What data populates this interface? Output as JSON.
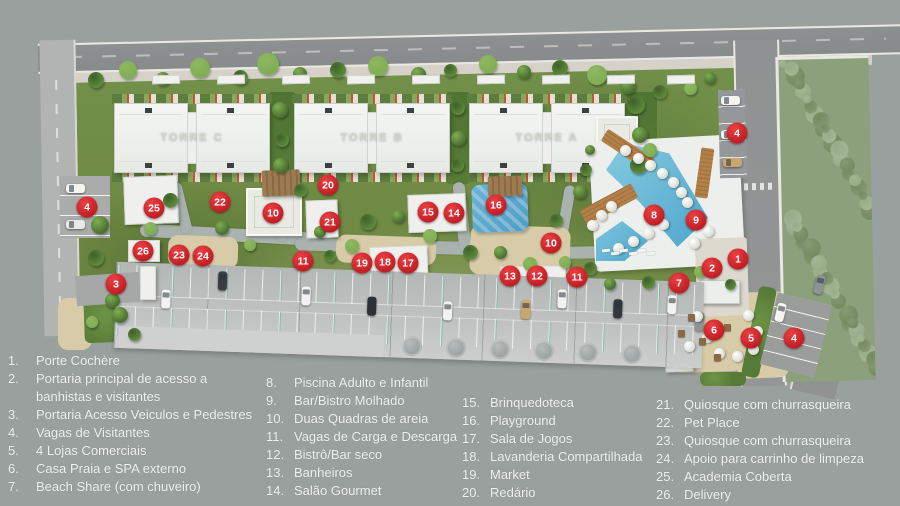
{
  "map": {
    "towers": [
      {
        "label": "TORRE C"
      },
      {
        "label": "TORRE B"
      },
      {
        "label": "TORRE A"
      }
    ],
    "markers": [
      {
        "num": "1",
        "x": 738,
        "y": 259
      },
      {
        "num": "2",
        "x": 712,
        "y": 268
      },
      {
        "num": "3",
        "x": 116,
        "y": 284
      },
      {
        "num": "4",
        "x": 87,
        "y": 207
      },
      {
        "num": "4",
        "x": 737,
        "y": 133
      },
      {
        "num": "4",
        "x": 794,
        "y": 338
      },
      {
        "num": "5",
        "x": 751,
        "y": 338
      },
      {
        "num": "6",
        "x": 714,
        "y": 330
      },
      {
        "num": "7",
        "x": 679,
        "y": 283
      },
      {
        "num": "8",
        "x": 654,
        "y": 215
      },
      {
        "num": "9",
        "x": 696,
        "y": 220
      },
      {
        "num": "10",
        "x": 273,
        "y": 213
      },
      {
        "num": "10",
        "x": 551,
        "y": 243
      },
      {
        "num": "11",
        "x": 303,
        "y": 261
      },
      {
        "num": "11",
        "x": 577,
        "y": 277
      },
      {
        "num": "12",
        "x": 537,
        "y": 276
      },
      {
        "num": "13",
        "x": 510,
        "y": 276
      },
      {
        "num": "14",
        "x": 454,
        "y": 213
      },
      {
        "num": "15",
        "x": 428,
        "y": 212
      },
      {
        "num": "16",
        "x": 496,
        "y": 205
      },
      {
        "num": "17",
        "x": 408,
        "y": 263
      },
      {
        "num": "18",
        "x": 385,
        "y": 262
      },
      {
        "num": "19",
        "x": 362,
        "y": 263
      },
      {
        "num": "20",
        "x": 328,
        "y": 185
      },
      {
        "num": "21",
        "x": 330,
        "y": 222
      },
      {
        "num": "22",
        "x": 220,
        "y": 202
      },
      {
        "num": "23",
        "x": 179,
        "y": 255
      },
      {
        "num": "24",
        "x": 203,
        "y": 256
      },
      {
        "num": "25",
        "x": 154,
        "y": 208
      },
      {
        "num": "26",
        "x": 143,
        "y": 251
      }
    ],
    "colors": {
      "background_gray": "#9aa09d",
      "road_gray": "#8b8e8e",
      "grass_green": "#6e8844",
      "pool_blue": "#5fb0d3",
      "sand_tan": "#d8cca8",
      "wood_brown": "#b28049",
      "marker_red": "#c81f24",
      "legend_text": "#eff1ee"
    }
  },
  "legend": {
    "columns": [
      {
        "items": [
          {
            "num": "1.",
            "text": "Porte Cochère"
          },
          {
            "num": "2.",
            "text": "Portaria principal de acesso a banhistas e visitantes"
          },
          {
            "num": "3.",
            "text": "Portaria Acesso Veiculos e Pedestres"
          },
          {
            "num": "4.",
            "text": "Vagas de Visitantes"
          },
          {
            "num": "5.",
            "text": "4 Lojas Comerciais"
          },
          {
            "num": "6.",
            "text": "Casa Praia e SPA externo"
          },
          {
            "num": "7.",
            "text": "Beach Share (com chuveiro)"
          }
        ]
      },
      {
        "items": [
          {
            "num": "8.",
            "text": "Piscina Adulto e Infantil"
          },
          {
            "num": "9.",
            "text": "Bar/Bistro Molhado"
          },
          {
            "num": "10.",
            "text": "Duas Quadras de areia"
          },
          {
            "num": "11.",
            "text": "Vagas de Carga e Descarga"
          },
          {
            "num": "12.",
            "text": "Bistrô/Bar seco"
          },
          {
            "num": "13.",
            "text": "Banheiros"
          },
          {
            "num": "14.",
            "text": "Salão Gourmet"
          }
        ]
      },
      {
        "items": [
          {
            "num": "15.",
            "text": "Brinquedoteca"
          },
          {
            "num": "16.",
            "text": "Playground"
          },
          {
            "num": "17.",
            "text": "Sala de Jogos"
          },
          {
            "num": "18.",
            "text": "Lavanderia Compartilhada"
          },
          {
            "num": "19.",
            "text": "Market"
          },
          {
            "num": "20.",
            "text": "Redário"
          }
        ]
      },
      {
        "items": [
          {
            "num": "21.",
            "text": "Quiosque com churrasqueira"
          },
          {
            "num": "22.",
            "text": "Pet Place"
          },
          {
            "num": "23.",
            "text": "Quiosque com churrasqueira"
          },
          {
            "num": "24.",
            "text": "Apoio para carrinho de limpeza"
          },
          {
            "num": "25.",
            "text": "Academia Coberta"
          },
          {
            "num": "26.",
            "text": "Delivery"
          }
        ]
      }
    ]
  }
}
